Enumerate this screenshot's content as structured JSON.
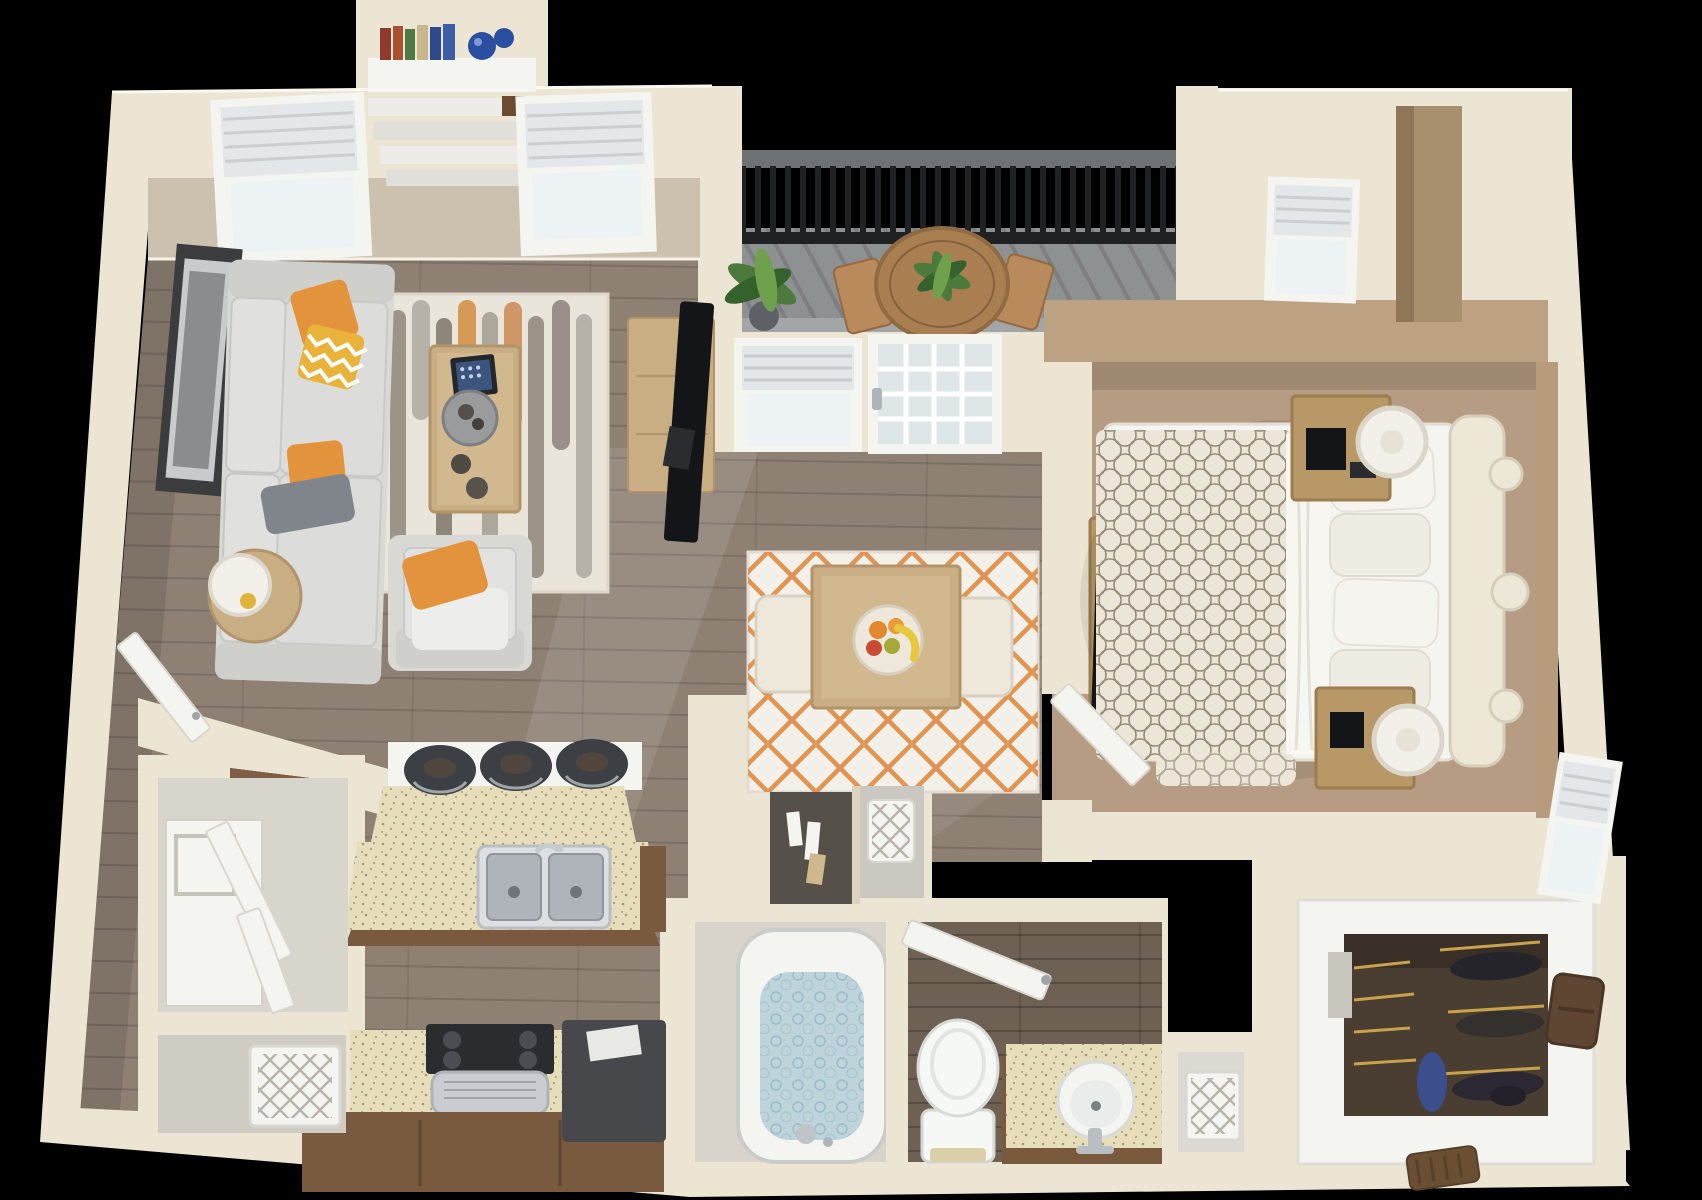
{
  "scene": {
    "title": "3D top-down floor plan render of a one-bedroom, one-bathroom apartment with balcony",
    "view": "dollhouse overhead 3D render",
    "background": "#000000"
  },
  "palette": {
    "background": "#000000",
    "wall": "#EDE5D3",
    "wallShadow": "#D7CCB7",
    "wallFace": "#CCC1AE",
    "bedroomWallFace": "#BCA183",
    "nicheTan": "#A8906F",
    "woodFloor": "#8E8174",
    "bedroomCarpet": "#B59C82",
    "bathroomFloor": "#6E6154",
    "balconyDeck": "#8E9192",
    "railingBlack": "#1F2123",
    "fixtureWhite": "#F4F4F1",
    "furnitureCream": "#EDE8DA",
    "sofaGray": "#D8D8D5",
    "pillowGray": "#80858C",
    "accentOrange": "#E2933C",
    "chevronYellow": "#E9B33B",
    "rugBase": "#EAE5DB",
    "rugOrange": "#C57C3F",
    "rugTaupe": "#9C9489",
    "rugGray": "#B7B2A9",
    "diningRug": "#F3F0EA",
    "latticeOrange": "#DD8B3E",
    "furnitureWood": "#C9AE83",
    "nightstandWood": "#B99868",
    "counterGranite": "#E6DDBB",
    "speckle": "#8F7D52",
    "cabinetBrown": "#7A5A3E",
    "fridgeBrown": "#6F523C",
    "stainlessSteel": "#C9CDD1",
    "charcoal": "#3C3F44",
    "tvBlack": "#141518",
    "tubWater": "#BFD3DA",
    "toiletWhite": "#F6F8F6",
    "closetInterior": "#4A3D31",
    "brassRod": "#C9A24B",
    "plantGreen": "#4C7A3C",
    "plantDark": "#35612C",
    "decorBlue": "#2A4FA0",
    "bagBrown": "#5E4632",
    "duvetPattern": "#948C78",
    "balconyTableWood": "#A97F52"
  },
  "rooms": [
    {
      "id": "living-room",
      "label": "Living room"
    },
    {
      "id": "dining-area",
      "label": "Dining area"
    },
    {
      "id": "kitchen",
      "label": "Kitchen"
    },
    {
      "id": "entry",
      "label": "Entry"
    },
    {
      "id": "laundry-closet",
      "label": "Laundry closet"
    },
    {
      "id": "pantry-closet",
      "label": "Pantry / hamper closet"
    },
    {
      "id": "balcony",
      "label": "Balcony"
    },
    {
      "id": "bedroom",
      "label": "Bedroom"
    },
    {
      "id": "bathroom",
      "label": "Bathroom"
    },
    {
      "id": "tub-room",
      "label": "Tub room"
    },
    {
      "id": "hall-closets",
      "label": "Hall storage cubbies"
    },
    {
      "id": "linen-closet",
      "label": "Linen closet"
    },
    {
      "id": "walk-in-closet",
      "label": "Walk-in closet"
    }
  ],
  "furniture": {
    "living_room": [
      "sofa with orange and gray pillows",
      "armchair with orange pillow",
      "patterned area rug",
      "coffee table with tablet and tray",
      "round side table with lamp",
      "wall art frame",
      "two blinded windows",
      "built-in bookshelf with books and blue vases",
      "tv console with flat tv"
    ],
    "dining_area": [
      "dining table",
      "two cream chairs",
      "fruit bowl",
      "orange lattice rug",
      "window",
      "french glass door to balcony"
    ],
    "kitchen": [
      "granite island with double sink and faucet",
      "three dark barstools",
      "brown refrigerator",
      "range with hood",
      "brown base cabinets",
      "dark dishwasher"
    ],
    "balcony": [
      "black slat railing",
      "round wood table with potted plant",
      "two wood chairs",
      "potted floor plant",
      "plank decking"
    ],
    "bedroom": [
      "bed with patterned duvet and pillows",
      "scalloped headboard",
      "two wood nightstands with drum lamps",
      "alarm clock",
      "media console with tv",
      "two blinded windows",
      "open door"
    ],
    "bathroom": [
      "soaking tub with water",
      "toilet",
      "vanity with vessel sink and faucet",
      "open door"
    ],
    "closets": [
      "washer",
      "white hamper baskets",
      "towel cubby",
      "toiletry cubby",
      "hanging clothes",
      "brown handbag",
      "shoes",
      "brass clothing rods"
    ]
  }
}
